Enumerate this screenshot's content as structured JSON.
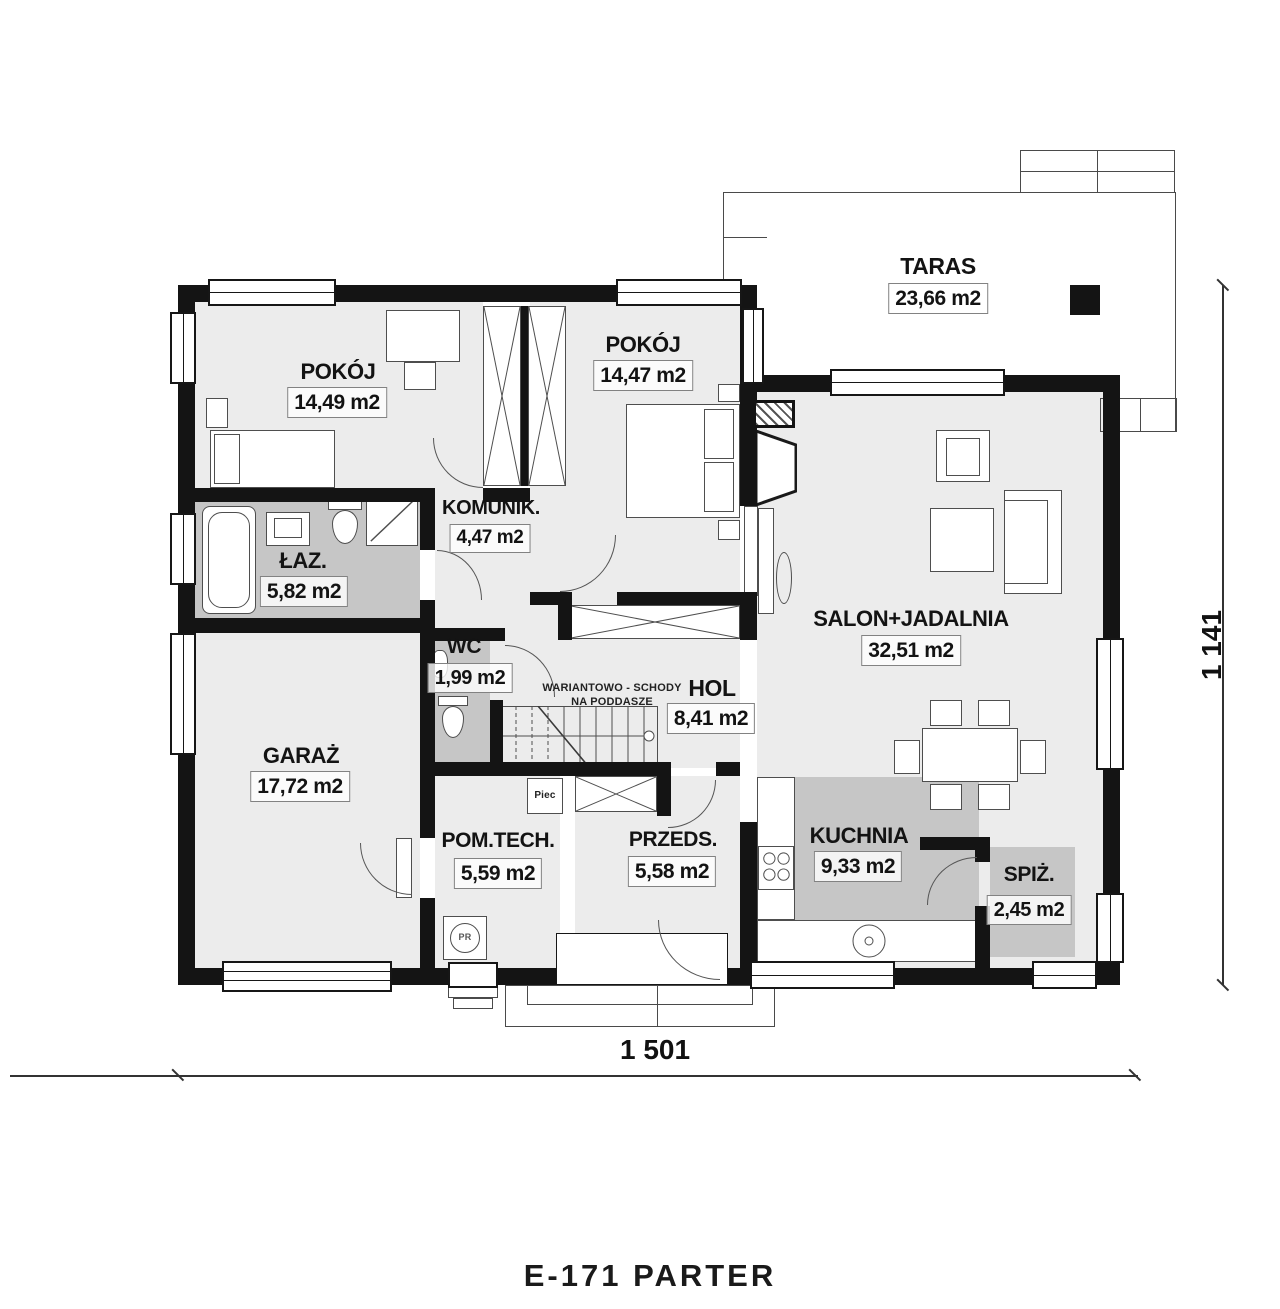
{
  "plan": {
    "title": "E-171 PARTER",
    "rooms": {
      "taras": {
        "name": "TARAS",
        "area": "23,66 m2"
      },
      "pokoj1": {
        "name": "POKÓJ",
        "area": "14,49 m2"
      },
      "pokoj2": {
        "name": "POKÓJ",
        "area": "14,47 m2"
      },
      "komunik": {
        "name": "KOMUNIK.",
        "area": "4,47 m2"
      },
      "laz": {
        "name": "ŁAZ.",
        "area": "5,82 m2"
      },
      "wc": {
        "name": "WC",
        "area": "1,99 m2"
      },
      "hol": {
        "name": "HOL",
        "area": "8,41 m2"
      },
      "salon": {
        "name": "SALON+JADALNIA",
        "area": "32,51 m2"
      },
      "garaz": {
        "name": "GARAŻ",
        "area": "17,72 m2"
      },
      "pomtech": {
        "name": "POM.TECH.",
        "area": "5,59 m2"
      },
      "przeds": {
        "name": "PRZEDS.",
        "area": "5,58 m2"
      },
      "kuchnia": {
        "name": "KUCHNIA",
        "area": "9,33 m2"
      },
      "spiz": {
        "name": "SPIŻ.",
        "area": "2,45 m2"
      }
    },
    "notes": {
      "stairs_line1": "WARIANTOWO - SCHODY",
      "stairs_line2": "NA PODDASZE",
      "furnace": "Piec",
      "pr": "PR"
    },
    "dimensions": {
      "width": "1 501",
      "height": "1 141"
    },
    "colors": {
      "wall": "#141414",
      "floor_light": "#ececec",
      "floor_dark": "#c6c6c6"
    }
  }
}
